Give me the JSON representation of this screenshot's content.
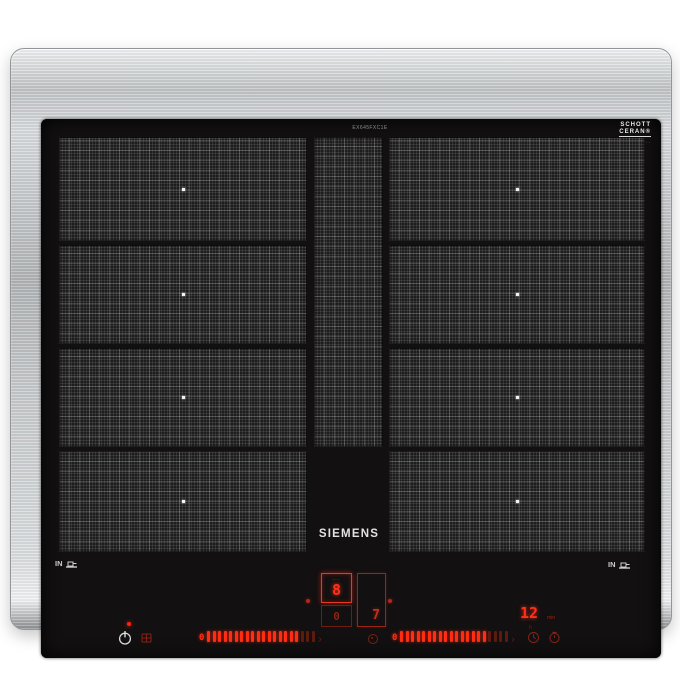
{
  "brand": {
    "name": "SIEMENS"
  },
  "labels": {
    "model_code": "EX645FXC1E",
    "schott_line1": "SCHOTT",
    "schott_line2": "CERAN®",
    "schott_fineprint": "· ··· ···· ·· ·····",
    "pan_detect_left": "IN",
    "pan_detect_right": "IN"
  },
  "colors": {
    "accent_red": "#ff2d12",
    "dim_red": "#7a2014",
    "steel": "#c6c9cb",
    "glass_black": "#121011"
  },
  "controls": {
    "zone_display": {
      "level_label": "···",
      "level": "8",
      "secondary": "0",
      "right_level": "7"
    },
    "timer": {
      "value": "12",
      "unit": "min",
      "sub_unit": "h"
    },
    "slider_left": {
      "zero": "0",
      "bright_bars": 17,
      "dim_bars": 3,
      "arrow": "›"
    },
    "slider_right": {
      "zero": "0",
      "bright_bars": 16,
      "dim_bars": 4,
      "arrow": "›"
    }
  }
}
